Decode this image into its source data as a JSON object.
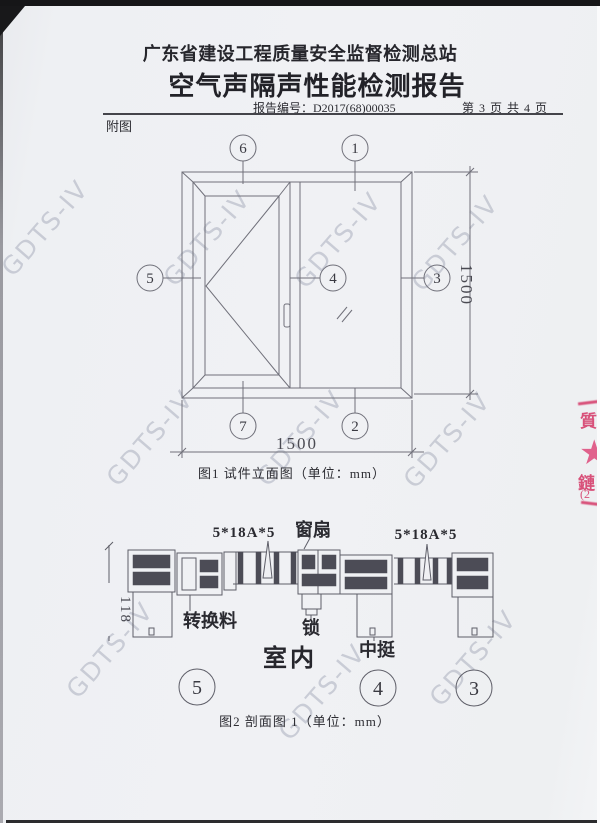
{
  "header": {
    "org": "广东省建设工程质量安全监督检测总站",
    "title": "空气声隔声性能检测报告",
    "report_no_label": "报告编号：",
    "report_no": "D2017(68)00035",
    "page_info": "第 3 页 共 4 页",
    "attachment_label": "附图"
  },
  "figure1": {
    "caption": "图1 试件立面图（单位：mm）",
    "callouts": [
      "1",
      "2",
      "3",
      "4",
      "5",
      "6",
      "7"
    ],
    "dim_width": "1500",
    "dim_height": "1500"
  },
  "figure2": {
    "caption": "图2  剖面图 1（单位：mm）",
    "labels": {
      "glass_left": "5*18A*5",
      "sash": "窗扇",
      "glass_right": "5*18A*5",
      "transition": "转换料",
      "lock": "锁",
      "indoor": "室内",
      "mullion": "中挺",
      "dim_depth": "118"
    },
    "callouts": [
      "5",
      "4",
      "3"
    ]
  },
  "watermark": {
    "text": "GDTS-IV"
  },
  "stamp": {
    "char_top": "質",
    "char_bottom": "鏈",
    "fragment": "(2",
    "color": "#d8517a"
  }
}
